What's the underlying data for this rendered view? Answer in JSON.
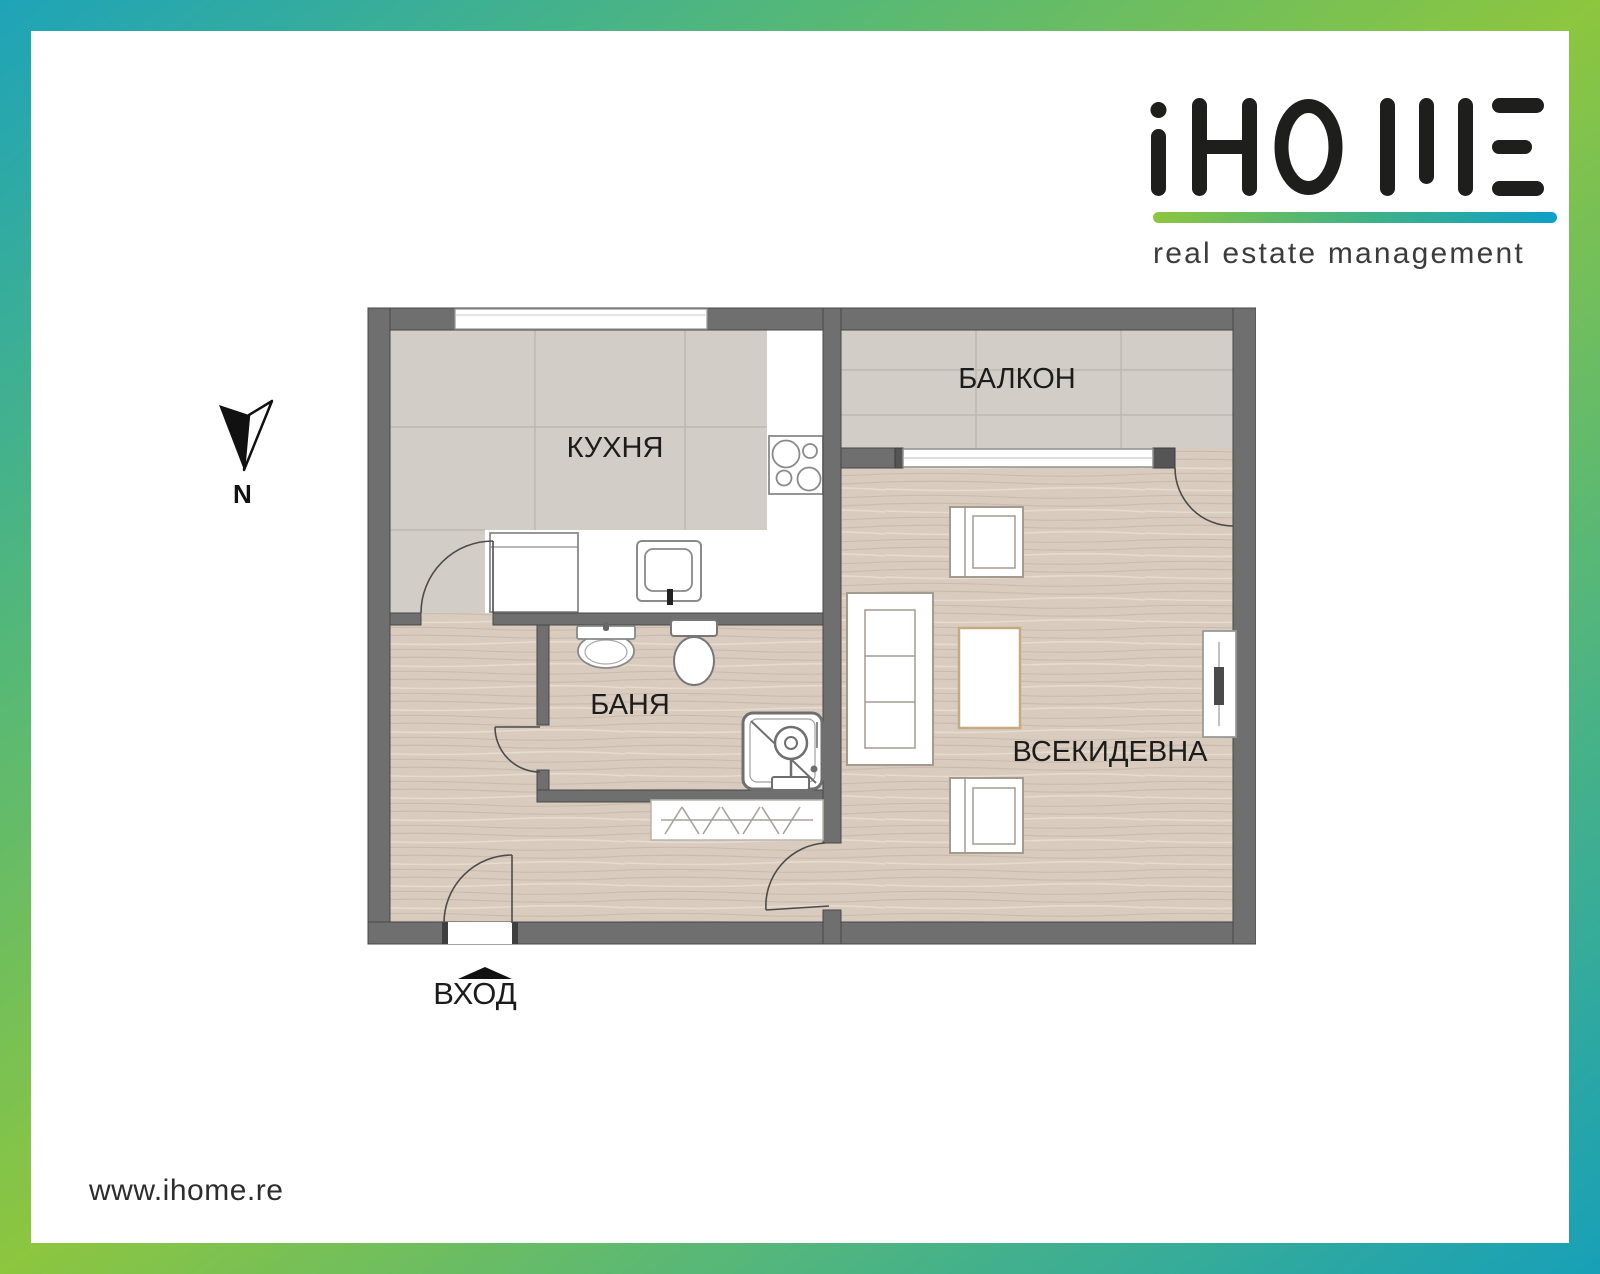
{
  "logo": {
    "brand": "iHOME",
    "tagline": "real estate management",
    "underline_gradient": [
      "#8dc63f",
      "#0e9fc6"
    ]
  },
  "compass": {
    "label": "N",
    "direction": "north"
  },
  "plan": {
    "rooms": {
      "kitchen": {
        "label": "КУХНЯ",
        "floor": "tile",
        "fixtures": [
          "stove-icon",
          "kitchen-sink-icon",
          "cabinet"
        ]
      },
      "balcony": {
        "label": "БАЛКОН",
        "floor": "tile"
      },
      "bathroom": {
        "label": "БАНЯ",
        "floor": "wood",
        "fixtures": [
          "bath-sink-icon",
          "toilet-icon",
          "shower-icon"
        ]
      },
      "living": {
        "label": "ВСЕКИДЕВНА",
        "floor": "wood",
        "furniture": [
          "sofa",
          "coffee-table",
          "armchair",
          "armchair",
          "tv-unit"
        ]
      },
      "hallway": {
        "floor": "wood",
        "furniture": [
          "wardrobe"
        ]
      }
    },
    "entrance": {
      "label": "ВХОД"
    }
  },
  "footer": {
    "website": "www.ihome.re"
  },
  "colors": {
    "frame_teal": "#1ea4b8",
    "frame_green": "#8dc63f",
    "wall": "#6f6f6f",
    "tile_floor": "#d2cec7",
    "wood_floor": "#d9ccbf"
  }
}
